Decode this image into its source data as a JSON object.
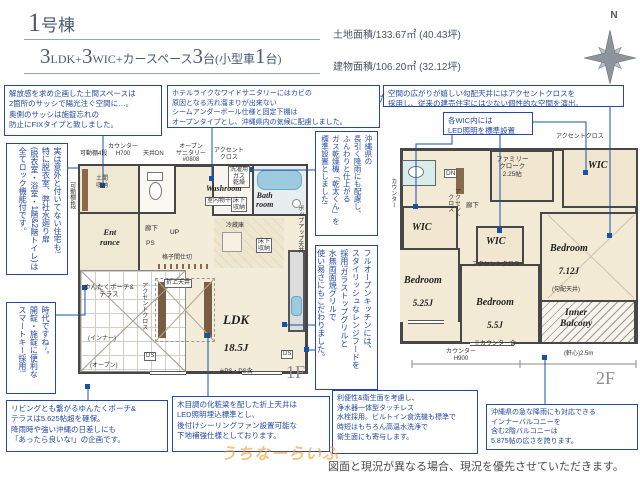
{
  "header": {
    "building_no": "1",
    "building_suffix": "号棟",
    "layout_segments": [
      {
        "t": "3"
      },
      {
        "t": "LDK+"
      },
      {
        "t": "3"
      },
      {
        "t": "WIC+カースペース"
      },
      {
        "t": "3"
      },
      {
        "t": "台(小型車"
      },
      {
        "t": "1"
      },
      {
        "t": "台)"
      }
    ],
    "land_area": "土地面積/133.67㎡ (40.43坪)",
    "building_area": "建物面積/106.20㎡ (32.12坪)",
    "area_note": "※1階:ゆんたくポーチ&テラス部分7.25㎡を含みます。",
    "compass_label": "N"
  },
  "callouts": {
    "doma": "解放感を求め企画した土間スペースは\n2箇所のサッシで陽光注ぐ空間に…。\n奥側のサッシは施錠忘れの\n防止にFIXタイプと致しました。",
    "sanitary": "ホテルライクなワイドサニタリーにはカビの\n原因となる汚れ溜まりが出来ない\nシームアンダーボール仕様と固定下棚は\nオープンタイプとし、沖縄県内の気候に配慮しました。",
    "sloped_ceiling": "空間の広がりが嬉しい勾配天井にはアクセントクロスを\n採用し、従来の建売住宅には少ない個性的な空間を演出。",
    "wic_led": "各WIC内には\nLED照明を標準設置",
    "door_lock": "実は意外と付いてない住宅も!\n特に脱衣室、弊社水廻り扉\n(脱衣室・浴室・1階&2階トイレ)は\n全てロック機能付です。",
    "smart_key": "時代ですね~。\n開錠・施錠に便利な\nスマートキー採用!",
    "gas_dryer": "沖縄県の\n長引く降雨にも配慮し、\nふんわりと仕上がる\nガス乾燥機「乾太くん」を\n標準設置としました!",
    "kitchen": "フルオープンキッチンには、\nスタイリッシュなレンジフードを\n採用!ガラストップグリルと\n水無両面焼グリルで\n使い易さにもこだわりました。",
    "porch": "リビングとも繋がるゆんたくポーチ&\nテラスは5.625帖超を確保。\n降雨時や強い沖縄の日差しにも\n「あったら良いな!」の企画です。",
    "ceiling_beam": "木目調の化粧梁を配した折上天井は\nLED照明埋込標準とし、\n後付けシーリングファン設置可能な\n下地補強仕様としております。",
    "faucet": "利便性&衛生面を考慮し、\n浄水器一体型タッチレス\n水栓採用。ビルトイン食洗機も標準で\n時短はもちろん高温水洗浄で\n衛生面にも寄与します。",
    "balcony": "沖縄県の急な降雨にも対応できる\nインナーバルコニーを\n含む2階バルコニーは\n5.875帖の広さを誇ります。"
  },
  "plan1f": {
    "floor_label": "1F",
    "rooms": {
      "ldk_name": "LDK",
      "ldk_size": "18.5J",
      "ldk_note": "※PS・DS含",
      "entrance": "Ent\nrance",
      "washroom": "Washroom",
      "bathroom": "Bath\nroom",
      "doma": "土間\n収納",
      "porch": "ゆんたくポーチ&\nテラス",
      "porch_inner": "(インナー)",
      "porch_open": "(オープン)"
    },
    "labels": {
      "shelf_top": "可動棚4段",
      "shelf_side": "可動棚4段",
      "counter": "カウンター\nH700",
      "ceiling_dn": "天井DN",
      "open_sanitary": "オープン\nサニタリー\n#0808",
      "accent_top": "アクセント\nクロス",
      "accent_side": "アクセントクロス",
      "gas_tap": "洗濯用\nガス\n乾燥",
      "indoor_drying": "室内物干",
      "underfloor_wash": "床下\n収納",
      "underfloor_kitchen": "床下\n収納",
      "fridge": "冷蔵庫",
      "hall": "廊下",
      "ps": "PS",
      "up": "UP",
      "lattice": "格子間仕切",
      "coffered": "折上天井",
      "popup": "ポップアップ天井",
      "ds_left": "DS",
      "ds_right": "DS"
    }
  },
  "plan2f": {
    "floor_label": "2F",
    "rooms": {
      "bedroom1_name": "Bedroom",
      "bedroom1_size": "7.12J",
      "bedroom1_note": "(勾配天井)",
      "bedroom2_name": "Bedroom",
      "bedroom2_size": "5.25J",
      "bedroom3_name": "Bedroom",
      "bedroom3_size": "5.5J",
      "bedroom3_note": "※カウンター含",
      "wic_top": "WIC",
      "wic_left": "WIC",
      "wic_mid": "WIC",
      "family_cloak": "ファミリー\nクローク\n2.25帖",
      "inner_balcony": "Inner\nBalcony",
      "hall": "廊下"
    },
    "labels": {
      "dn": "DN",
      "counter_side": "カウンター",
      "accent_top": "アクセントクロス",
      "accent_left": "アクセント\nクロス",
      "accent_mid": "アクセントクロス",
      "counter_h900": "カウンター\nH900",
      "eaves": "(軒心)2.5m"
    }
  },
  "footer": {
    "disclaimer": "図面と現況が異なる場合、現況を優先させていただきます。",
    "watermark": "うちなーらいふ"
  },
  "colors": {
    "accent_blue": "#2347a2",
    "wall": "#474747",
    "cream": "#f2ecd8",
    "fixture_blue": "#9ccadf",
    "watermark_orange": "#f39b2d"
  }
}
